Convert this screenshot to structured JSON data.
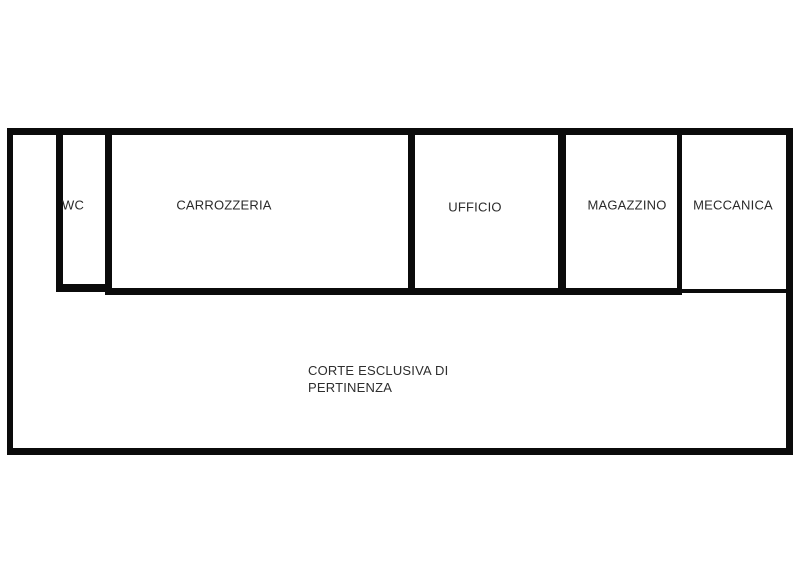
{
  "plan": {
    "colors": {
      "wall": "#0b0b0b",
      "text": "#2a2a2a",
      "background": "#ffffff"
    },
    "rooms": [
      {
        "label": "WC"
      },
      {
        "label": "CARROZZERIA"
      },
      {
        "label": "UFFICIO"
      },
      {
        "label": "MAGAZZINO"
      },
      {
        "label": "MECCANICA"
      }
    ],
    "courtyard": {
      "label_line1": "CORTE ESCLUSIVA DI",
      "label_line2": "PERTINENZA"
    }
  }
}
